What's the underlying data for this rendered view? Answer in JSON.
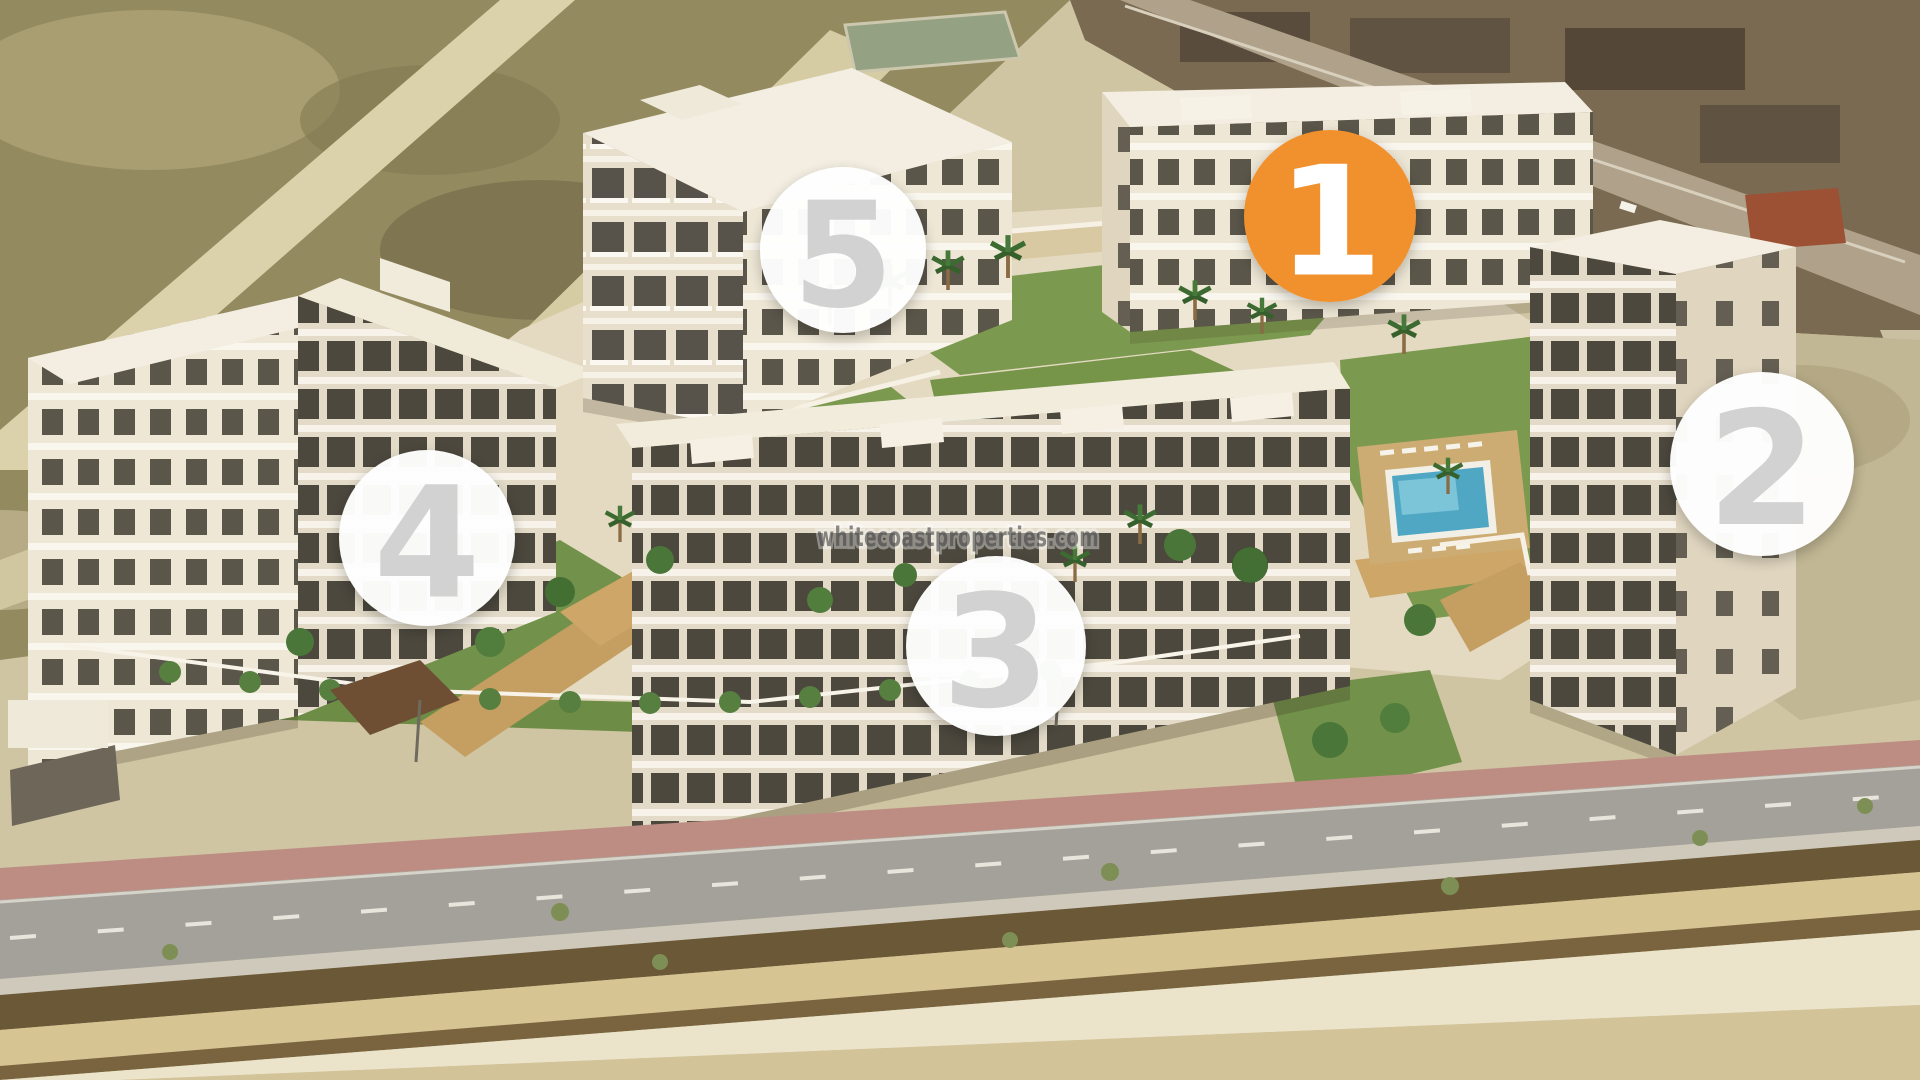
{
  "scene": {
    "watermark": "whitecoastproperties.com"
  },
  "badges": [
    {
      "number": "1",
      "highlighted": true
    },
    {
      "number": "2",
      "highlighted": false
    },
    {
      "number": "3",
      "highlighted": false
    },
    {
      "number": "4",
      "highlighted": false
    },
    {
      "number": "5",
      "highlighted": false
    }
  ],
  "colors": {
    "badge_highlight": "#f0912d",
    "badge_default": "#ffffff",
    "number_on_highlight": "#ffffff",
    "number_default": "#d2d2d2",
    "watermark": "#474747"
  }
}
